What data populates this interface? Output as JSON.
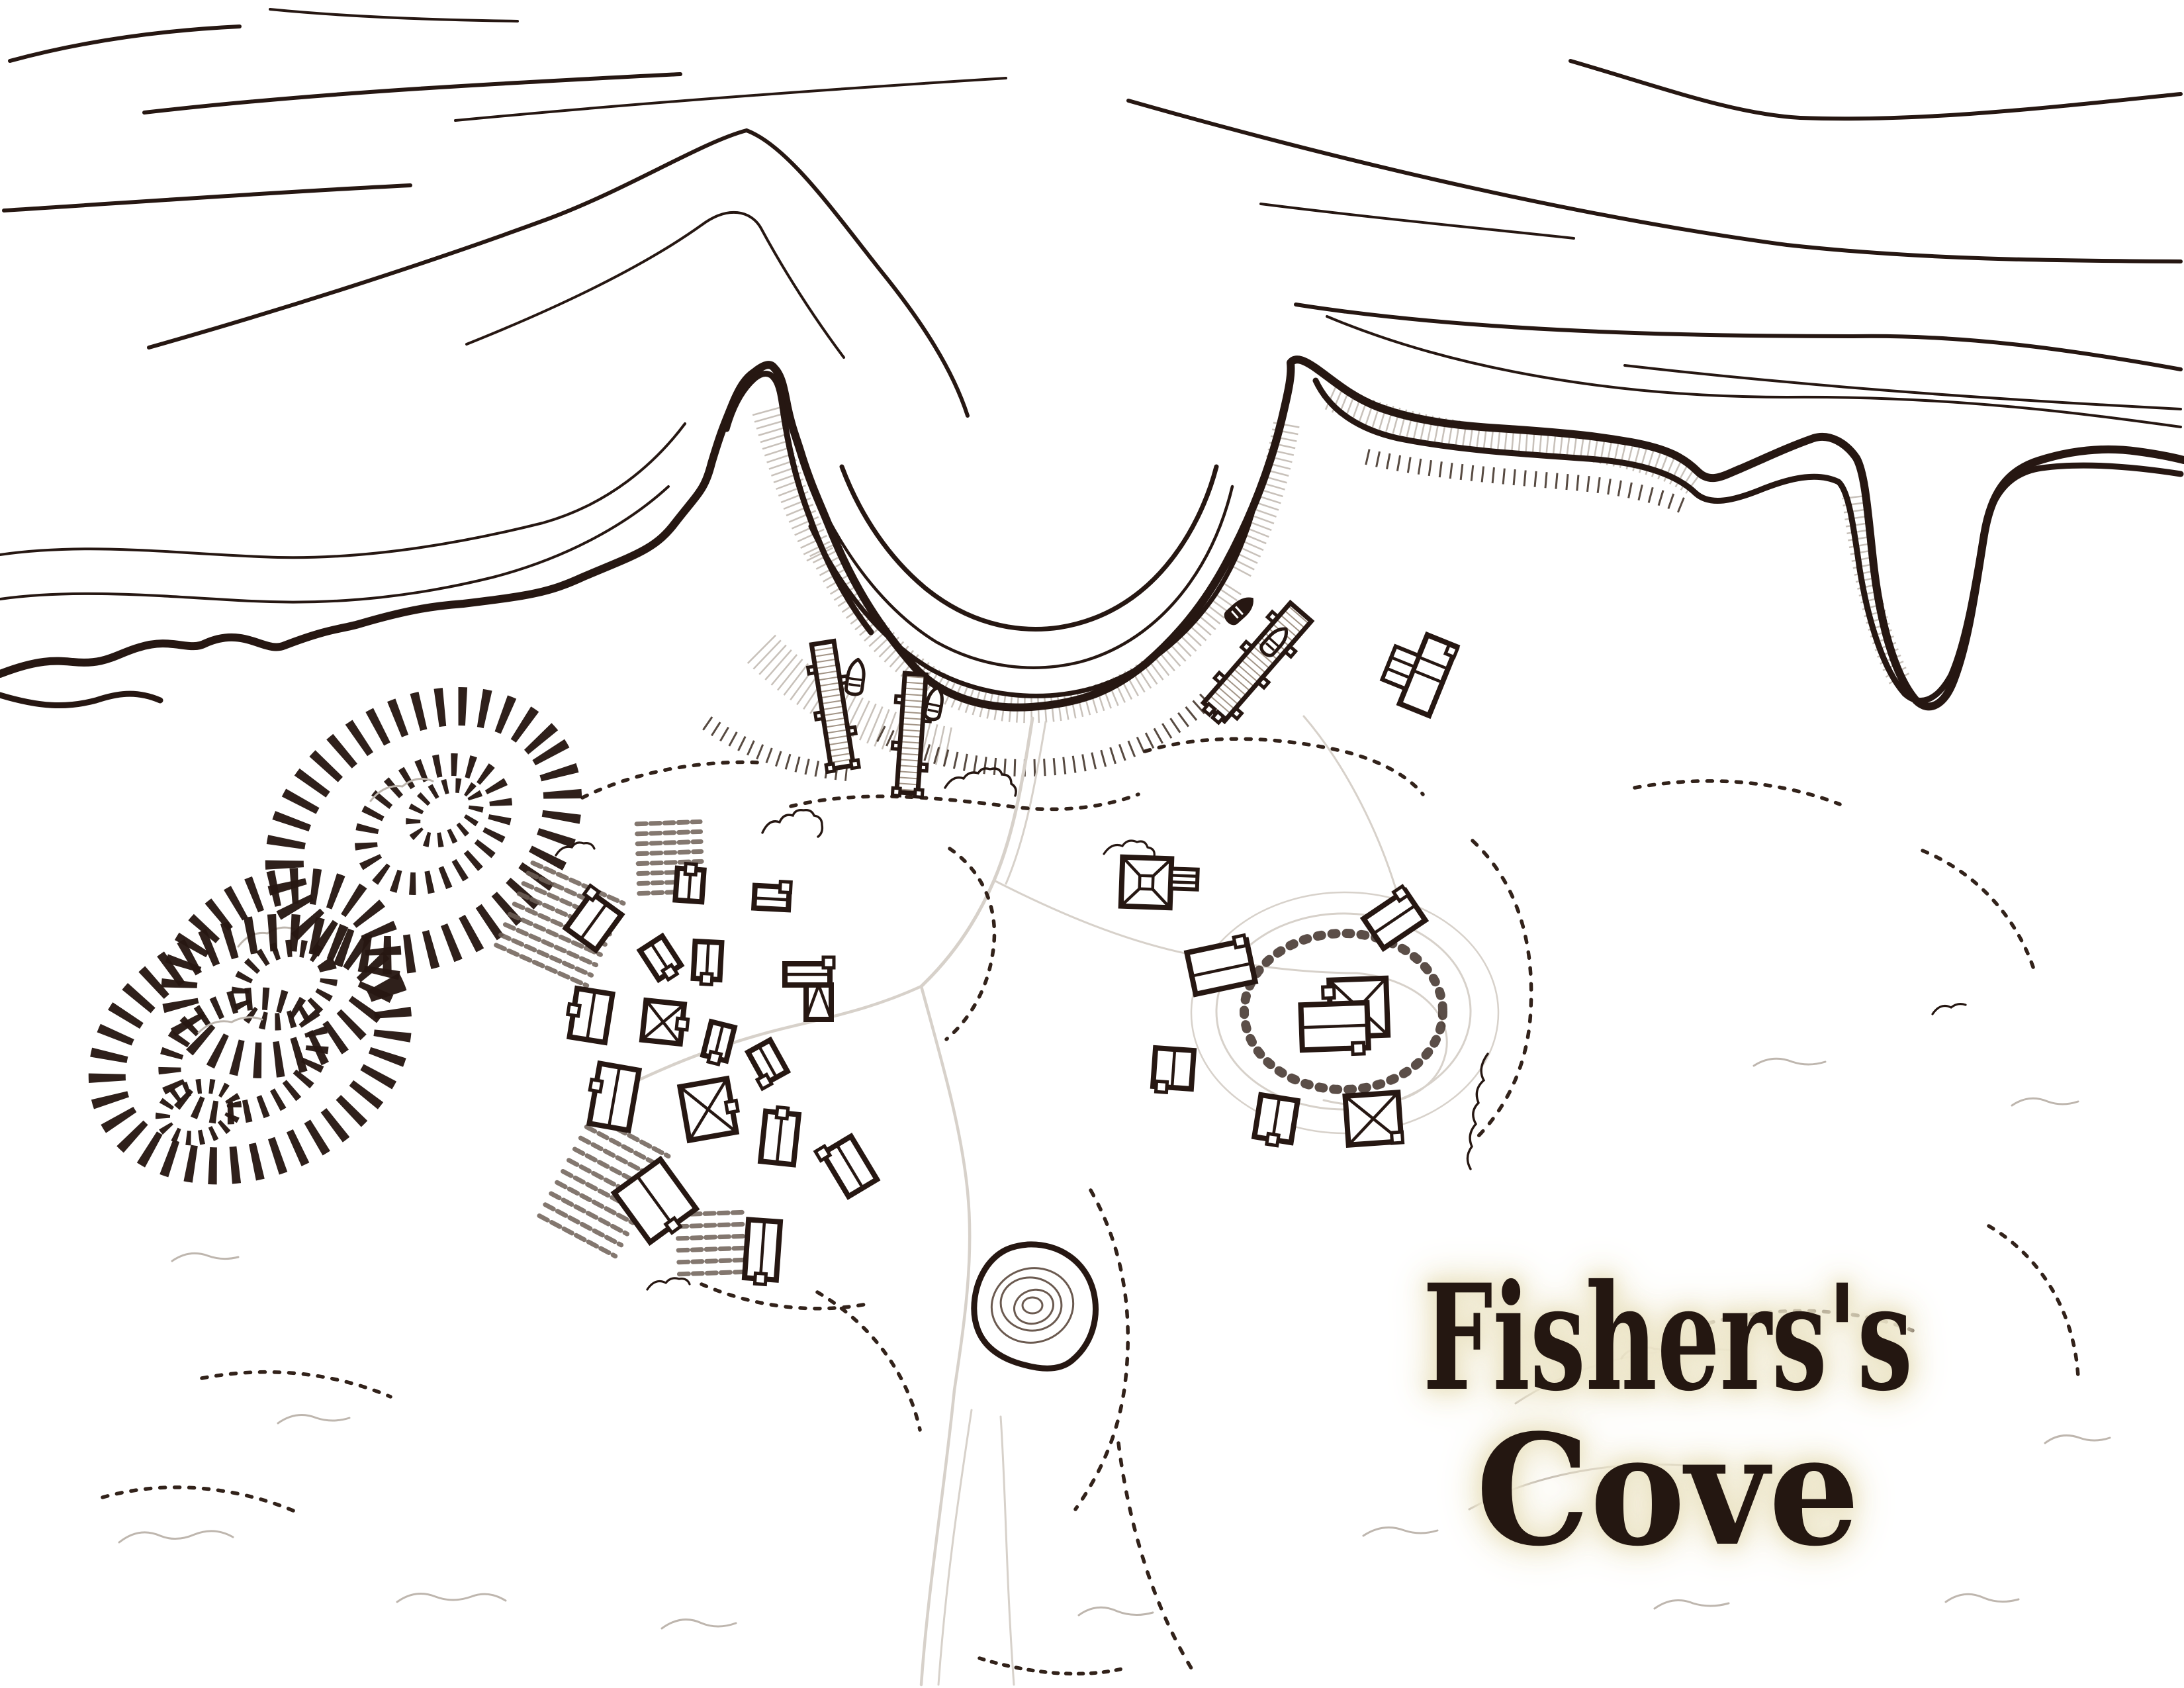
{
  "map": {
    "title": "Fishers's Cove",
    "title_line1": "Fishers's",
    "title_line2": "Cove",
    "type": "hand-drawn black-ink coastal village map on white paper",
    "colors": {
      "ink": "#261712",
      "paper": "#ffffff",
      "field_rows": "#6e6057",
      "light_detail": "#beb6ae",
      "road": "#d7d1ca",
      "beach_hatch": "#c8c1ba",
      "title_fill": "#241711",
      "title_glow": "#ece5c8"
    },
    "features": {
      "sea": "open water with sweeping wave lines across the top",
      "cove": "horseshoe bay with sandy beach arcs",
      "inlet": "narrow winding tidal inlet west of the cove",
      "piers": 3,
      "long_dock": 1,
      "rowboats": 4,
      "buildings": 21,
      "field_plots": 4,
      "hachure_hills": 2,
      "pond": 1
    }
  }
}
